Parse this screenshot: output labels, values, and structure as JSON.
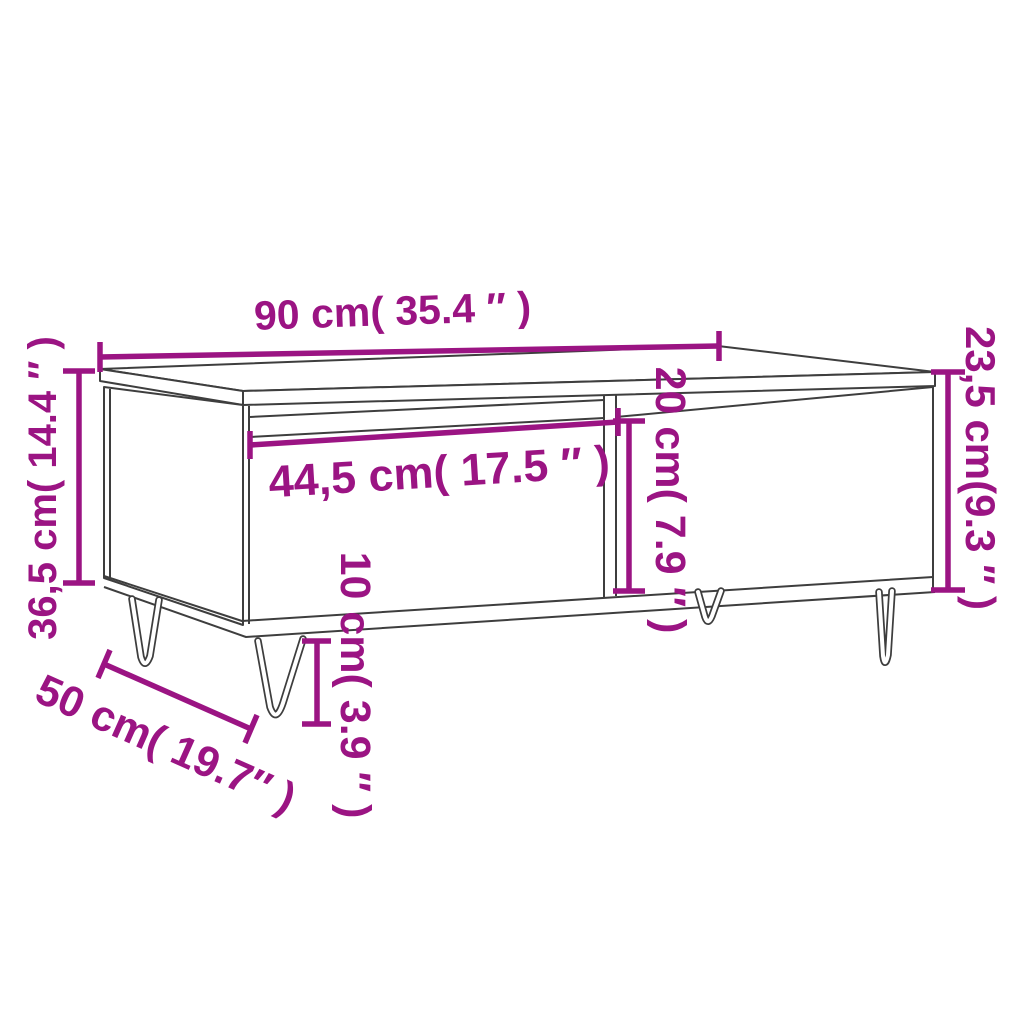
{
  "diagram": {
    "type": "furniture-dimension-diagram",
    "subject": "coffee table with drawer and hairpin legs",
    "background_color": "#FFFFFF",
    "outline_color": "#3E3E3E",
    "accent_color": "#9B1483",
    "dimensions": [
      {
        "id": "overall-width",
        "label": "90 cm( 35.4 ″ )",
        "value_cm": 90,
        "value_inch": 35.4,
        "orientation": "horizontal",
        "location": "top"
      },
      {
        "id": "overall-height",
        "label": "36,5 cm( 14.4 ″ )",
        "value_cm": 36.5,
        "value_inch": 14.4,
        "orientation": "vertical",
        "location": "left"
      },
      {
        "id": "body-height",
        "label": "23,5 cm(9.3 ″ )",
        "value_cm": 23.5,
        "value_inch": 9.3,
        "orientation": "vertical",
        "location": "right"
      },
      {
        "id": "drawer-width",
        "label": "44,5 cm( 17.5 ″ )",
        "value_cm": 44.5,
        "value_inch": 17.5,
        "orientation": "horizontal",
        "location": "drawer-front"
      },
      {
        "id": "compartment-height",
        "label": "20 cm( 7.9 ″ )",
        "value_cm": 20,
        "value_inch": 7.9,
        "orientation": "vertical",
        "location": "middle"
      },
      {
        "id": "leg-height",
        "label": "10 cm( 3.9 ″ )",
        "value_cm": 10,
        "value_inch": 3.9,
        "orientation": "vertical",
        "location": "bottom"
      },
      {
        "id": "overall-depth",
        "label": "50 cm( 19.7″ )",
        "value_cm": 50,
        "value_inch": 19.7,
        "orientation": "diagonal",
        "location": "bottom-left"
      }
    ]
  }
}
